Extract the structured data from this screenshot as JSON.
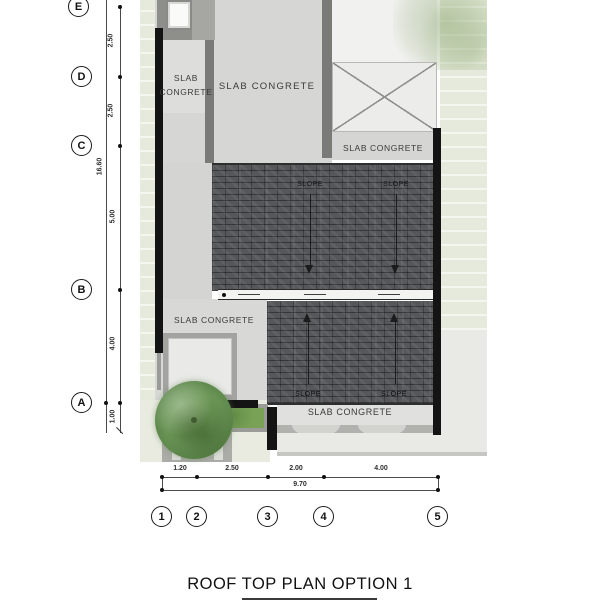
{
  "title": "ROOF TOP PLAN OPTION 1",
  "grid": {
    "rows": [
      {
        "label": "E"
      },
      {
        "label": "D"
      },
      {
        "label": "C"
      },
      {
        "label": "B"
      },
      {
        "label": "A"
      }
    ],
    "cols": [
      {
        "label": "1"
      },
      {
        "label": "2"
      },
      {
        "label": "3"
      },
      {
        "label": "4"
      },
      {
        "label": "5"
      }
    ]
  },
  "dimensions": {
    "vertical": {
      "segments": [
        "2.50",
        "2.50",
        "5.00",
        "4.00",
        "1.00"
      ],
      "overall": "16.60"
    },
    "horizontal": {
      "segments": [
        "1.20",
        "2.50",
        "2.00",
        "4.00"
      ],
      "overall": "9.70"
    }
  },
  "labels": {
    "slab_top_left": {
      "line1": "SLAB",
      "line2": "CONGRETE"
    },
    "slab_top_center": "SLAB CONGRETE",
    "slab_upper_right": "SLAB CONGRETE",
    "slab_mid_left": "SLAB CONGRETE",
    "slab_bottom": "SLAB CONGRETE",
    "slope": "SLOPE"
  },
  "colors": {
    "roof_tile": "#55575a",
    "slab_concrete": "#d6d6d4",
    "wall_black": "#141414",
    "wall_gray": "#7a7a77",
    "grass": "#79a257",
    "tree": "#699455",
    "landscape": "#e6eadc"
  }
}
